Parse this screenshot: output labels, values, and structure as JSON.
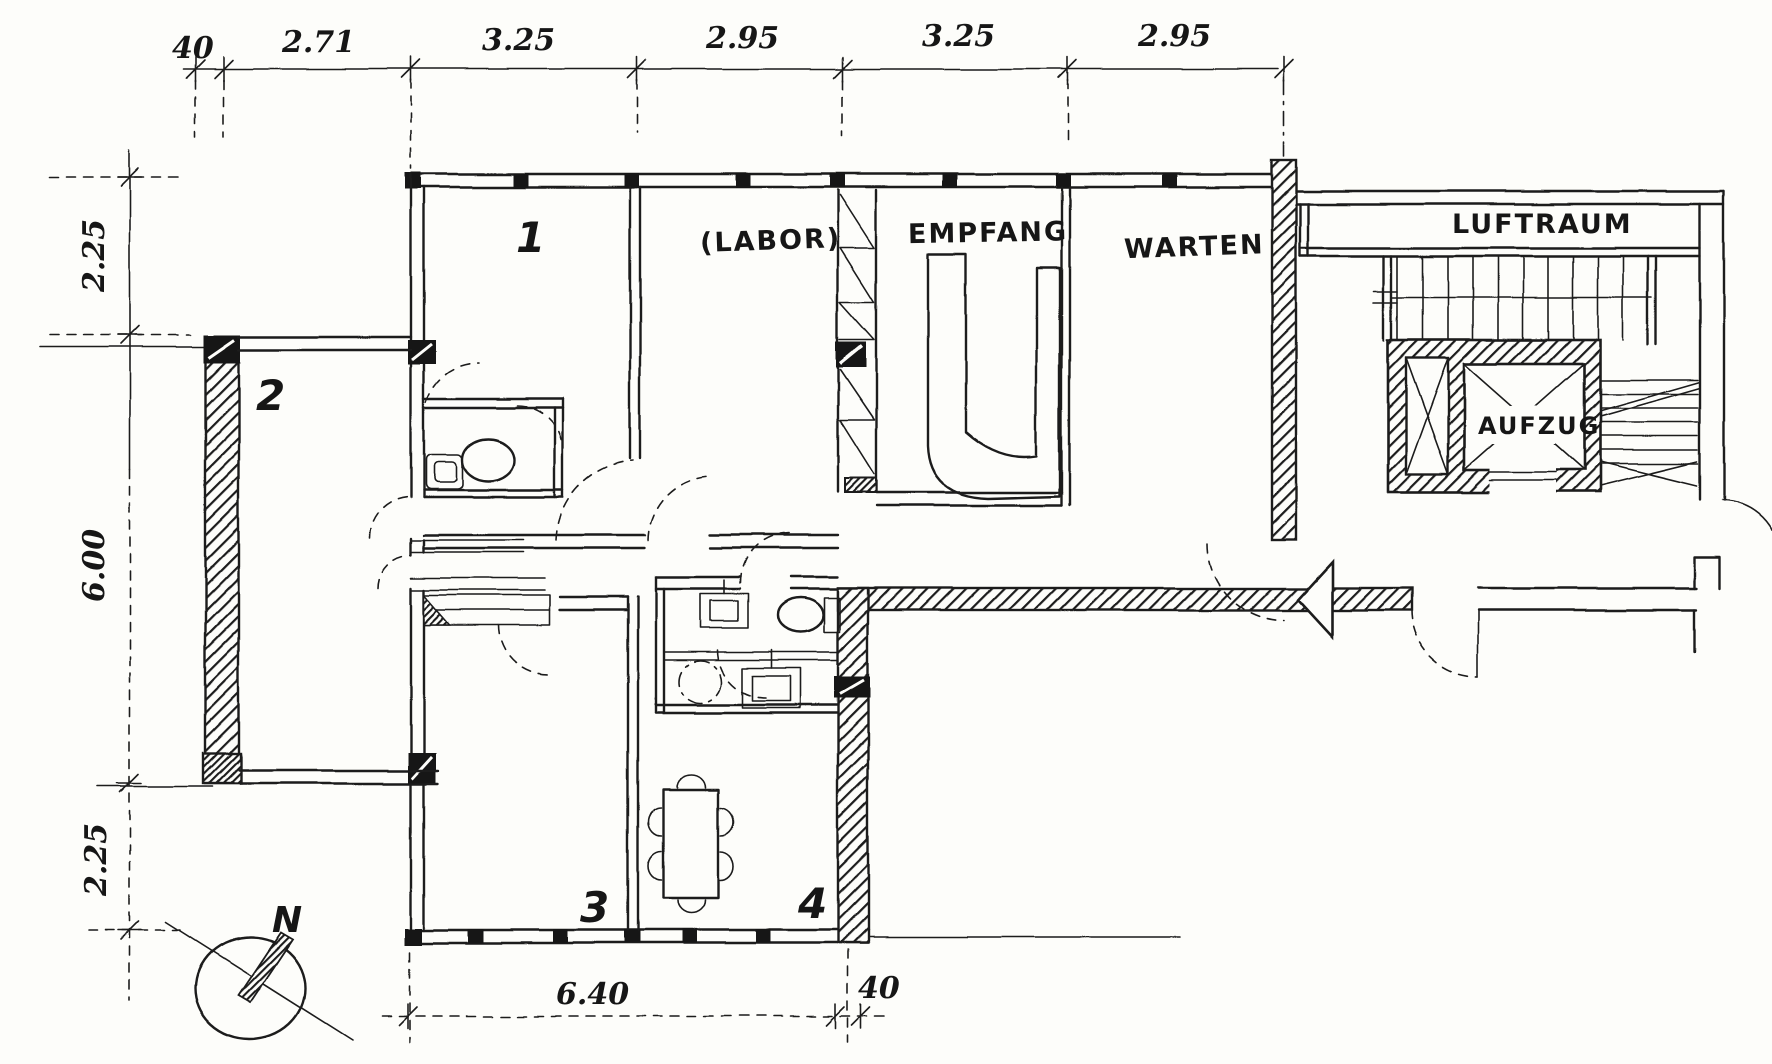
{
  "rooms": {
    "r1": "1",
    "r2": "2",
    "r3": "3",
    "r4": "4",
    "labor": "(LABOR)",
    "empfang": "EMPFANG",
    "warten": "WARTEN",
    "luftraum": "LUFTRAUM",
    "aufzug": "AUFZUG"
  },
  "dimensions": {
    "top": [
      "40",
      "2.71",
      "3.25",
      "2.95",
      "3.25",
      "2.95"
    ],
    "left": [
      "2.25",
      "6.00",
      "2.25"
    ],
    "bottom": [
      "6.40",
      "40"
    ]
  },
  "compass": {
    "north_label": "N"
  },
  "colors": {
    "ink": "#1b1b1b",
    "paper": "#fdfdfa"
  }
}
